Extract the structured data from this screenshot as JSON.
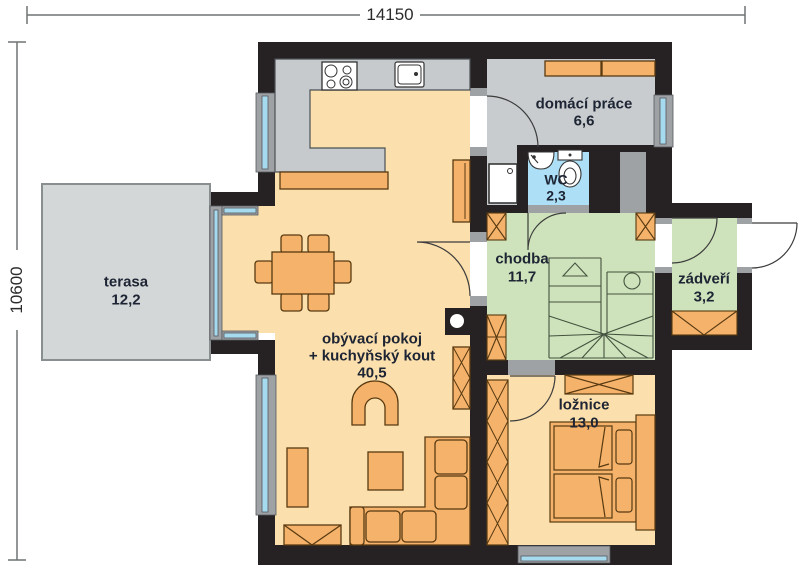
{
  "dimensions": {
    "width_label": "14150",
    "height_label": "10600"
  },
  "rooms": {
    "terasa": {
      "name": "terasa",
      "area": "12,2"
    },
    "living": {
      "name": "obývací pokoj",
      "name_line2": "+ kuchyňský kout",
      "area": "40,5"
    },
    "utility": {
      "name": "domácí práce",
      "area": "6,6"
    },
    "wc": {
      "name": "WC",
      "area": "2,3"
    },
    "hall": {
      "name": "chodba",
      "area": "11,7"
    },
    "entry": {
      "name": "zádveří",
      "area": "3,2"
    },
    "bedroom": {
      "name": "ložnice",
      "area": "13,0"
    }
  },
  "colors": {
    "wall": "#262122",
    "floor_peach": "#FBDFAC",
    "floor_gray": "#C9CCCE",
    "floor_green": "#CEE3BB",
    "floor_blue": "#ADE0F6",
    "terrace_gray": "#D4D7D8",
    "furniture_orange": "#F5B26B",
    "counter_gray": "#C6CACC",
    "window_glass": "#A6DAEF",
    "frame_gray": "#9EA2A5",
    "label_text": "#1D2433"
  }
}
